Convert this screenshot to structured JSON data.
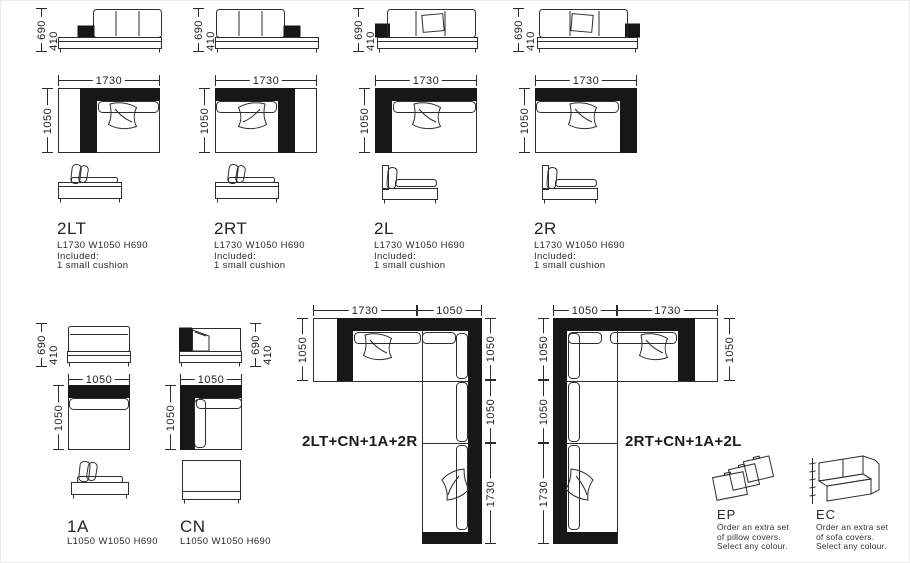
{
  "sheet": {
    "background": "#ffffff",
    "ink": "#171717"
  },
  "modules": [
    {
      "name": "2LT",
      "spec": "L1730 W1050 H690",
      "included_label": "Included:",
      "included_item": "1 small cushion",
      "dim_width": "1730",
      "dim_depth": "1050",
      "dim_height": "690",
      "dim_seat": "410"
    },
    {
      "name": "2RT",
      "spec": "L1730 W1050 H690",
      "included_label": "Included:",
      "included_item": "1 small cushion",
      "dim_width": "1730",
      "dim_depth": "1050",
      "dim_height": "690",
      "dim_seat": "410"
    },
    {
      "name": "2L",
      "spec": "L1730 W1050 H690",
      "included_label": "Included:",
      "included_item": "1 small cushion",
      "dim_width": "1730",
      "dim_depth": "1050",
      "dim_height": "690",
      "dim_seat": "410"
    },
    {
      "name": "2R",
      "spec": "L1730 W1050 H690",
      "included_label": "Included:",
      "included_item": "1 small cushion",
      "dim_width": "1730",
      "dim_depth": "1050",
      "dim_height": "690",
      "dim_seat": "410"
    },
    {
      "name": "1A",
      "spec": "L1050 W1050 H690",
      "dim_width": "1050",
      "dim_depth": "1050",
      "dim_height": "690",
      "dim_seat": "410"
    },
    {
      "name": "CN",
      "spec": "L1050 W1050 H690",
      "dim_width": "1050",
      "dim_depth": "1050",
      "dim_height": "690",
      "dim_seat": "410"
    }
  ],
  "combos": [
    {
      "title": "2LT+CN+1A+2R",
      "top_dims": [
        "1730",
        "1050"
      ],
      "left_dims": [
        "1050"
      ],
      "right_dims": [
        "1050",
        "1050",
        "1730"
      ]
    },
    {
      "title": "2RT+CN+1A+2L",
      "top_dims": [
        "1050",
        "1730"
      ],
      "left_dims": [
        "1050",
        "1050",
        "1730"
      ],
      "right_dims": [
        "1050"
      ]
    }
  ],
  "extras": [
    {
      "code": "EP",
      "line1": "Order an extra set",
      "line2": "of pillow covers.",
      "line3": "Select any colour."
    },
    {
      "code": "EC",
      "line1": "Order an extra set",
      "line2": "of sofa covers.",
      "line3": "Select any colour."
    }
  ]
}
